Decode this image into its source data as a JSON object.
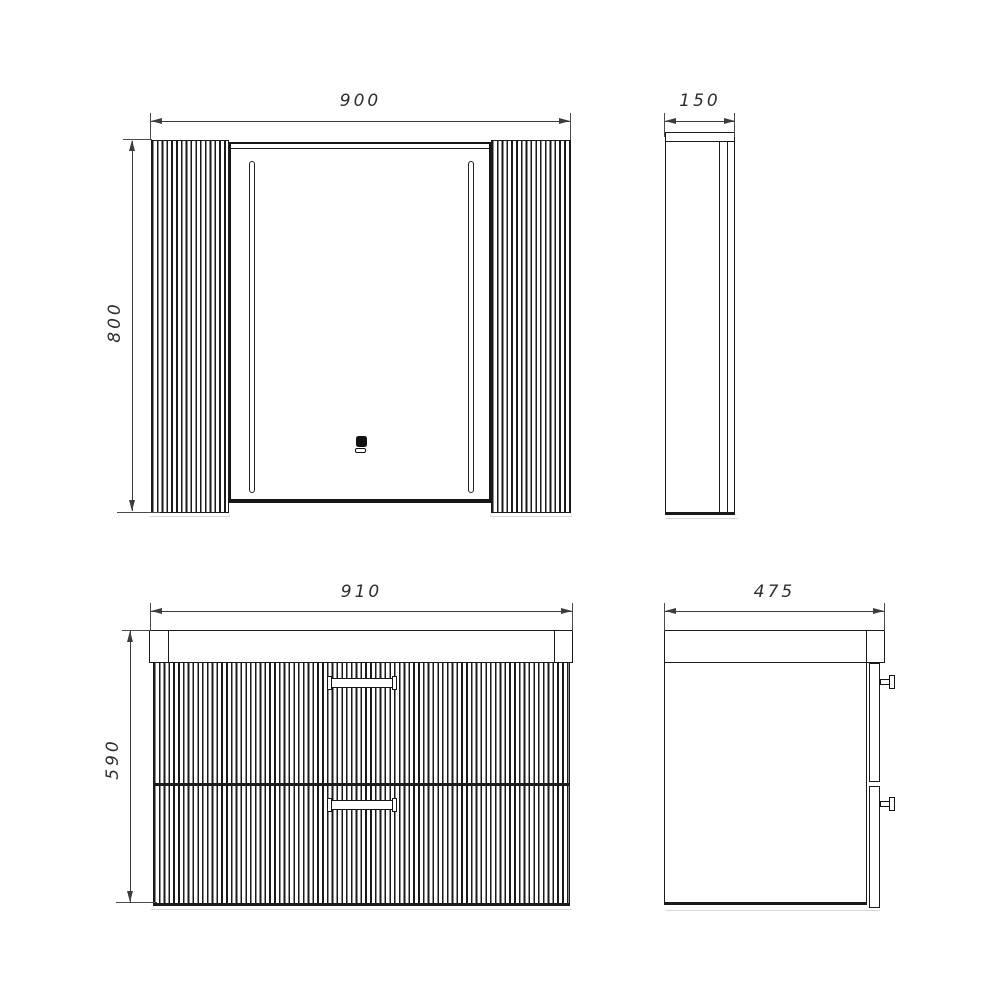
{
  "drawing": {
    "dimensions": {
      "mirror_front": {
        "width": "900",
        "height": "800"
      },
      "mirror_side": {
        "depth": "150"
      },
      "vanity_front": {
        "width": "910",
        "height": "590"
      },
      "vanity_side": {
        "depth": "475"
      }
    },
    "colors": {
      "background": "#ffffff",
      "object_line": "#1b1b1b",
      "dimension_line": "#3c3c3c",
      "label_text": "#2e2e2e"
    },
    "icons": {
      "touch_sensor": "touch-sensor-icon",
      "led_strips": "led-strip"
    }
  }
}
